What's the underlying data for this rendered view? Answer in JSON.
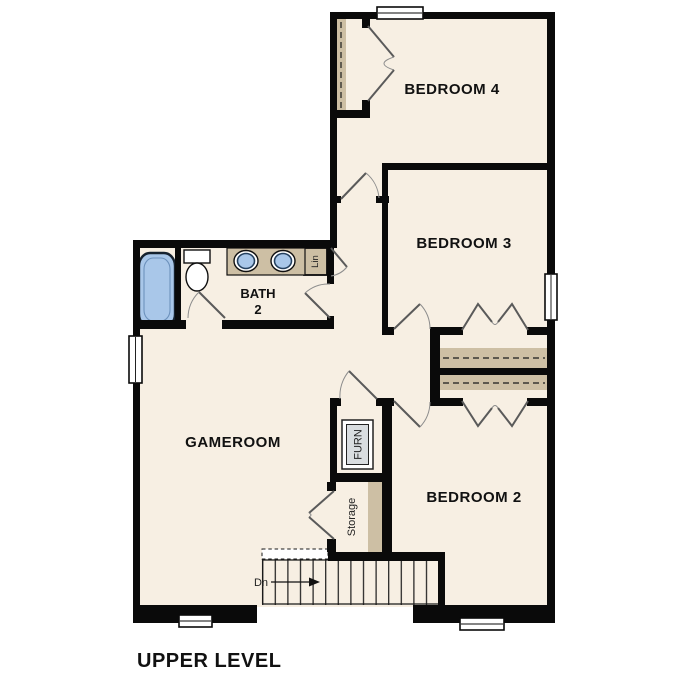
{
  "title": "UPPER LEVEL",
  "rooms": {
    "bedroom4": "BEDROOM 4",
    "bedroom3": "BEDROOM 3",
    "bedroom2": "BEDROOM 2",
    "gameroom": "GAMEROOM",
    "bath_line1": "BATH",
    "bath_line2": "2",
    "furnace": "FURN",
    "storage": "Storage",
    "linen": "Lin",
    "stairs_direction": "Dn"
  },
  "colors": {
    "background": "#ffffff",
    "floor": "#f7efe3",
    "wall": "#0a0a0a",
    "shelf": "#cdbfa4",
    "fixture_blue": "#a9c7e9",
    "fixture_outline": "#24405e",
    "furnace_fill": "#d9dde0",
    "door_stroke": "#5a5a5a",
    "window_fill": "#ffffff"
  }
}
